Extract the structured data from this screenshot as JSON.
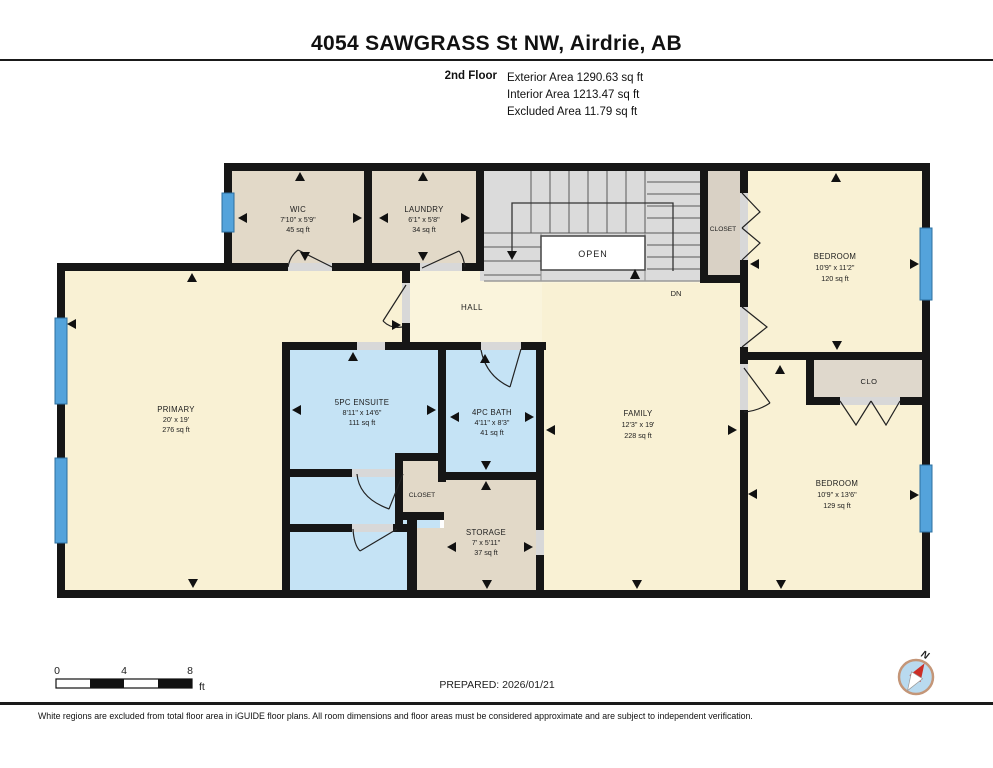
{
  "header": {
    "title": "4054 SAWGRASS St NW, Airdrie, AB",
    "floor_label": "2nd Floor",
    "areas": [
      "Exterior Area 1290.63 sq ft",
      "Interior Area 1213.47 sq ft",
      "Excluded Area 11.79 sq ft"
    ]
  },
  "rooms": {
    "wic": {
      "name": "WIC",
      "dims": "7'10\" x 5'9\"",
      "area": "45 sq ft"
    },
    "laundry": {
      "name": "LAUNDRY",
      "dims": "6'1\" x 5'8\"",
      "area": "34 sq ft"
    },
    "closet_top": {
      "name": "CLOSET"
    },
    "bedroom_top": {
      "name": "BEDROOM",
      "dims": "10'9\" x 11'2\"",
      "area": "120 sq ft"
    },
    "primary": {
      "name": "PRIMARY",
      "dims": "20' x 19'",
      "area": "276 sq ft"
    },
    "ensuite": {
      "name": "5PC ENSUITE",
      "dims": "8'11\" x 14'6\"",
      "area": "111 sq ft"
    },
    "bath": {
      "name": "4PC BATH",
      "dims": "4'11\" x 8'3\"",
      "area": "41 sq ft"
    },
    "closet_mid": {
      "name": "CLOSET"
    },
    "storage": {
      "name": "STORAGE",
      "dims": "7' x 5'11\"",
      "area": "37 sq ft"
    },
    "family": {
      "name": "FAMILY",
      "dims": "12'3\" x 19'",
      "area": "228 sq ft"
    },
    "hall": {
      "name": "HALL"
    },
    "clo": {
      "name": "CLO"
    },
    "bedroom_bottom": {
      "name": "BEDROOM",
      "dims": "10'9\" x 13'6\"",
      "area": "129 sq ft"
    },
    "stairs_open": {
      "name": "OPEN"
    },
    "stairs_dn": {
      "name": "DN"
    }
  },
  "scalebar": {
    "ticks": [
      "0",
      "4",
      "8"
    ],
    "unit": "ft"
  },
  "prepared_label": "PREPARED: 2026/01/21",
  "compass": {
    "north": "N"
  },
  "footer_note": "White regions are excluded from total floor area in iGUIDE floor plans. All room dimensions and floor areas must be considered approximate and are subject to independent verification.",
  "colors": {
    "wall": "#161616",
    "room_yellow": "#F9F1D4",
    "room_tan": "#E2D9C8",
    "room_blue": "#C5E3F5",
    "stairs_gray": "#DBDBDB",
    "window_blue": "#54A3DB",
    "window_border": "#2D6F9F",
    "compass_red": "#CC2E26",
    "compass_ring": "#C49678"
  }
}
